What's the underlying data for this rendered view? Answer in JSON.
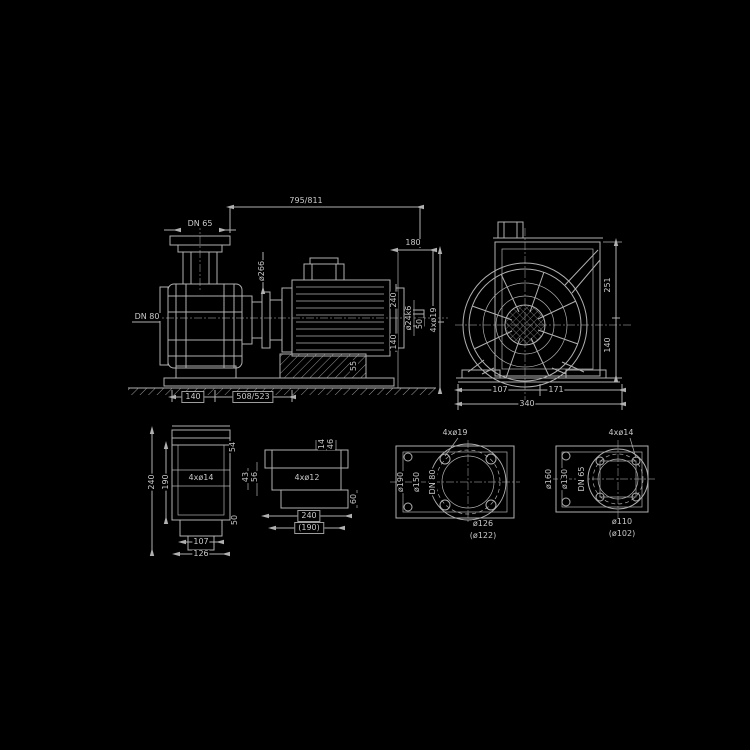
{
  "meta": {
    "background_color": "#000000",
    "line_color": "#b0b0b0",
    "text_color": "#c9c9c9",
    "drawing_type": "pump dimensional drawing"
  },
  "side_view": {
    "overall_length": "795/811",
    "discharge_flange": "DN 65",
    "suction_flange": "DN 80",
    "coupling_dia": "ø266",
    "motor_end": "180",
    "height_upper": "240",
    "height_lower": "140",
    "shaft_end": "ø24k6",
    "shaft_length": "50",
    "foot_holes": "4xø19",
    "base_height": "55",
    "foot_front": "140",
    "base_length": "508/523"
  },
  "end_view": {
    "height_upper": "251",
    "height_lower": "140",
    "foot_left": "107",
    "foot_right": "171",
    "base_width": "340"
  },
  "bracket_side_view": {
    "height_outer": "240",
    "height_inner": "190",
    "top_width": "54",
    "boss_width": "50",
    "hole_note": "4xø14",
    "foot_width": "107",
    "foot_outer": "126"
  },
  "bracket_top_view": {
    "edge_a": "14",
    "edge_b": "46",
    "side_a": "43",
    "side_b": "56",
    "side_right": "60",
    "hole_note": "4xø12",
    "width_outer": "240",
    "width_inner": "(190)"
  },
  "suction_flange_view": {
    "bolt_holes": "4xø19",
    "outer_dia": "ø190",
    "bolt_circle": "ø150",
    "nominal": "DN 80",
    "bore": "ø126",
    "recess": "(ø122)"
  },
  "discharge_flange_view": {
    "bolt_holes": "4xø14",
    "outer_dia": "ø160",
    "bolt_circle": "ø130",
    "nominal": "DN 65",
    "bore": "ø110",
    "recess": "(ø102)"
  }
}
